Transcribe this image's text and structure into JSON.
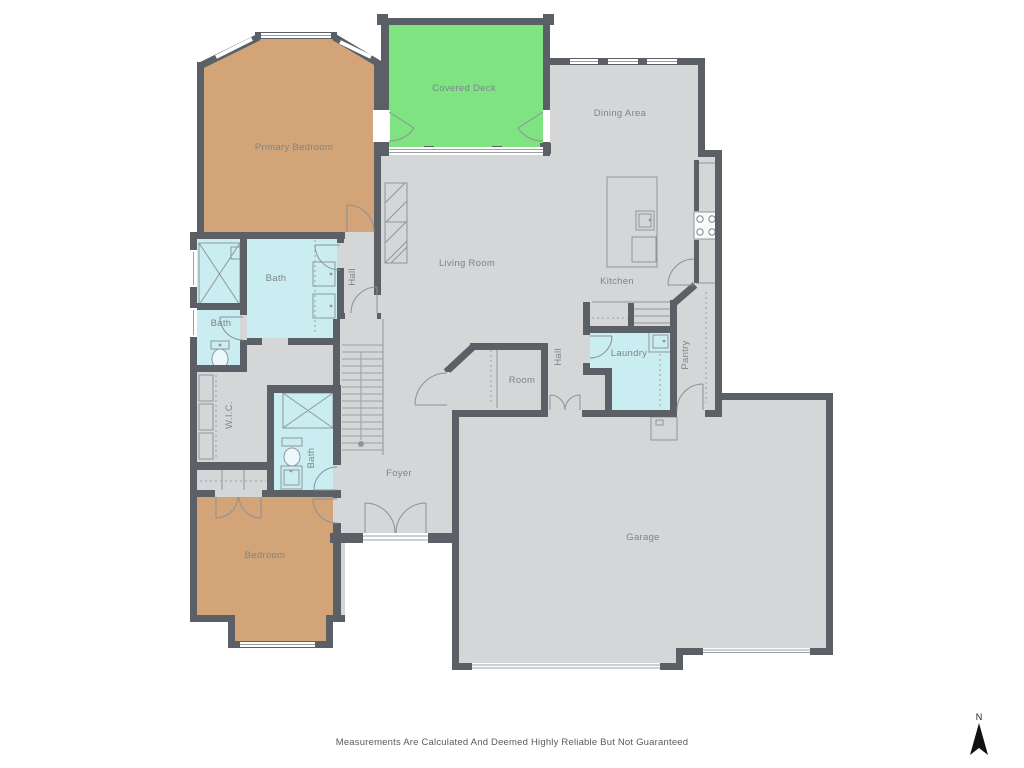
{
  "rooms": {
    "primary_bedroom": "Primary Bedroom",
    "covered_deck": "Covered Deck",
    "dining_area": "Dining Area",
    "living_room": "Living Room",
    "kitchen": "Kitchen",
    "pantry": "Pantry",
    "laundry": "Laundry",
    "hall_west": "Hall",
    "hall_center": "Hall",
    "room": "Room",
    "foyer": "Foyer",
    "wic": "W.I.C.",
    "bath_primary": "Bath",
    "bath_half": "Bath",
    "bath_second": "Bath",
    "bedroom": "Bedroom",
    "garage": "Garage"
  },
  "footer": {
    "disclaimer": "Measurements Are Calculated And Deemed Highly Reliable But Not Guaranteed"
  },
  "compass": {
    "north_label": "N"
  },
  "colors": {
    "floor": "#d5d6d7",
    "wall": "#5a6065",
    "bedroom_fill": "#d2a478",
    "deck_fill": "#80e382",
    "bath_fill": "#c9edf1",
    "label": "#7a858c"
  }
}
